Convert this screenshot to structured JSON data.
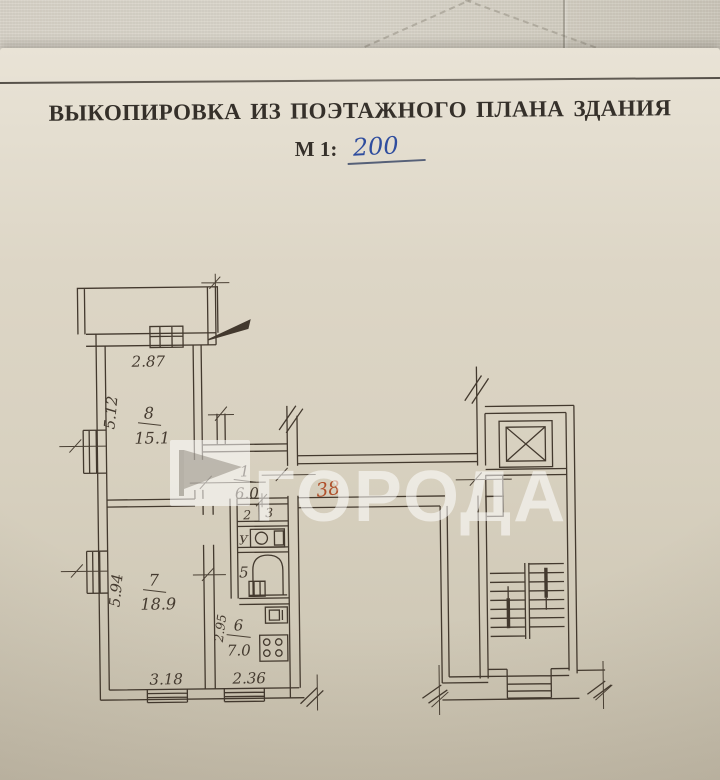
{
  "document": {
    "title": "ВЫКОПИРОВКА ИЗ ПОЭТАЖНОГО ПЛАНА ЗДАНИЯ",
    "scale_label": "М 1:",
    "scale_value": "200"
  },
  "watermark": {
    "logo": "flag-icon",
    "text": "ГОРОДА"
  },
  "plan": {
    "apartment_number_red": "38",
    "rooms": {
      "room8": {
        "number": "8",
        "area": "15.1"
      },
      "room7": {
        "number": "7",
        "area": "18.9"
      },
      "hall1": {
        "number": "1",
        "area": "6.0"
      },
      "room2": {
        "number": "2"
      },
      "room3": {
        "number": "3"
      },
      "bath5": {
        "number": "5"
      },
      "kitchen6": {
        "number": "6",
        "area": "7.0"
      }
    },
    "dimensions": {
      "room8_width": "2.87",
      "room8_depth": "5.12",
      "room7_depth": "5.94",
      "room7_width": "3.18",
      "kitchen_width": "2.36",
      "kitchen_depth": "2.95"
    },
    "marks": {
      "wc": "У"
    }
  },
  "colors": {
    "ink": "#43392e",
    "red_note": "#b0502b",
    "blue_ink": "#2f4d9e",
    "paper": "#ded7c8"
  }
}
